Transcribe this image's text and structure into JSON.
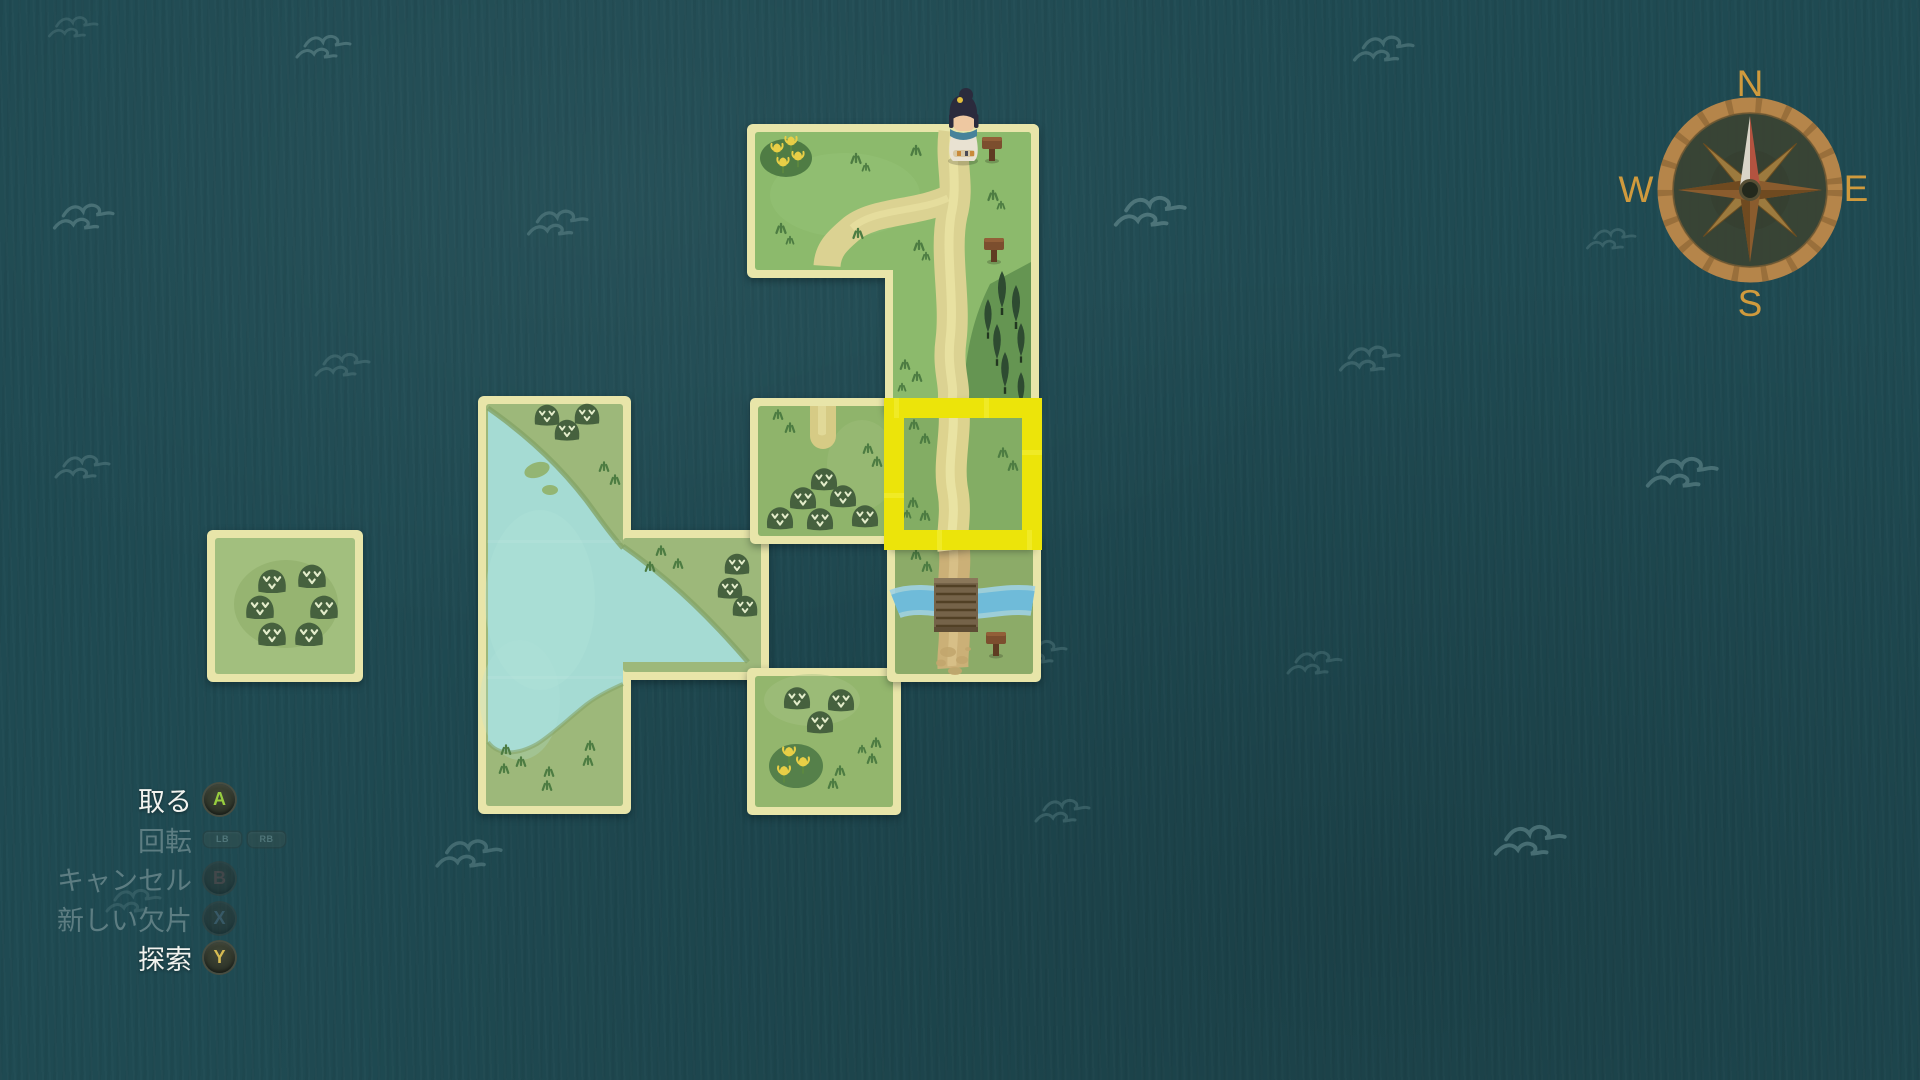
{
  "hud": {
    "actions": [
      {
        "label": "取る",
        "buttons": [
          "A"
        ],
        "enabled": true
      },
      {
        "label": "回転",
        "buttons": [
          "LB",
          "RB"
        ],
        "enabled": false
      },
      {
        "label": "キャンセル",
        "buttons": [
          "B"
        ],
        "enabled": false
      },
      {
        "label": "新しい欠片",
        "buttons": [
          "X"
        ],
        "enabled": false
      },
      {
        "label": "探索",
        "buttons": [
          "Y"
        ],
        "enabled": true
      }
    ]
  },
  "compass": {
    "north": "N",
    "east": "E",
    "south": "S",
    "west": "W"
  },
  "map": {
    "selection_highlight": {
      "color": "#ece40a",
      "tile_col": "E",
      "tile_row": 3
    },
    "pieces": [
      {
        "id": "path-fork-piece",
        "tiles": [
          "D1",
          "E1",
          "E2"
        ],
        "features": "forked path, flower patch, two signposts, cypress tree grove, player at top edge"
      },
      {
        "id": "held-path-piece",
        "tiles": [
          "E3"
        ],
        "features": "vertical path tile inside yellow selection frame",
        "selected": true
      },
      {
        "id": "bridge-piece",
        "tiles": [
          "E4"
        ],
        "features": "path crossing blue stream on wooden bridge, signpost, dirt patches"
      },
      {
        "id": "bush-path-stub-piece",
        "tiles": [
          "D3"
        ],
        "features": "six bushes, short path stub at top edge"
      },
      {
        "id": "lake-piece",
        "tiles": [
          "B3",
          "B4",
          "B5",
          "C4"
        ],
        "features": "large lake, diagonal shoreline, islets, bushes, grass shore"
      },
      {
        "id": "bush-flower-piece",
        "tiles": [
          "D5"
        ],
        "features": "three bushes, yellow flower patch"
      },
      {
        "id": "bush-piece",
        "tiles": [
          "A4"
        ],
        "features": "six bushes in a ring"
      }
    ],
    "player": {
      "description": "girl with dark topknot, teal scarf, white dress",
      "location": "top edge of tile E1"
    }
  },
  "colors": {
    "sea": "#1f4a52",
    "wave": "#52797e",
    "piece_border": "#e8e5a9",
    "grass": "#8cba6c",
    "lake_water": "#a5dbd3",
    "path": "#dbd292",
    "stream": "#6fbbd9",
    "selection": "#ece40a",
    "bush": "#46613e",
    "compass_gold": "#cf9a3d",
    "menu_active_text": "#f2f3ef",
    "menu_inactive_text": "#5d7d82",
    "button_a": "#97cd3f",
    "button_b": "#a34f4a",
    "button_x": "#5d89b4",
    "button_y": "#d6bb52"
  }
}
